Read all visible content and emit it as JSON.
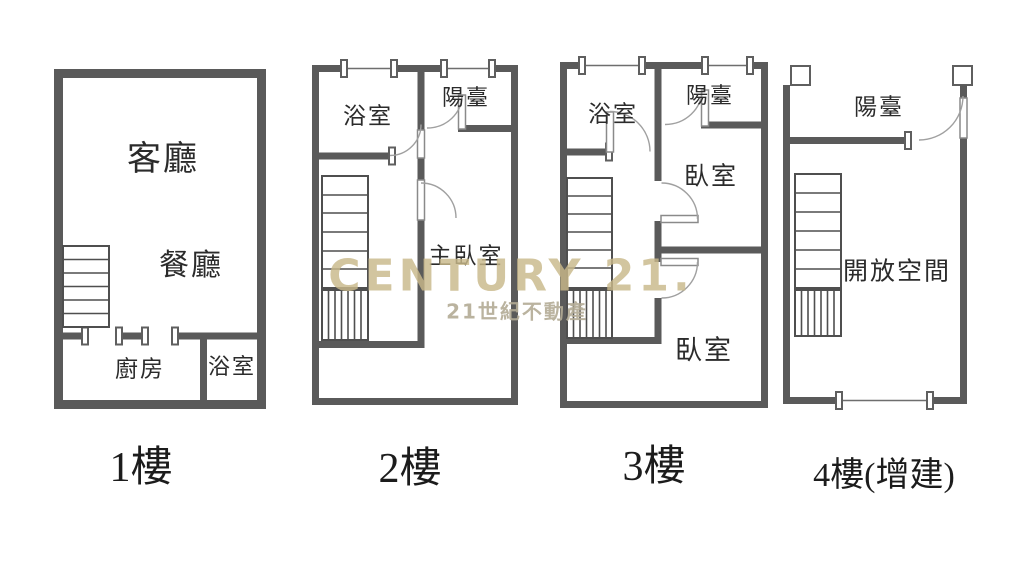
{
  "watermark": {
    "brand": "CENTURY 21.",
    "tagline": "21世紀不動產",
    "brand_color": "#c9b98a",
    "tagline_color": "#b3ab95"
  },
  "colors": {
    "background": "#ffffff",
    "wall": "#5a5a5a",
    "label_text": "#2b2b2b",
    "door_arc": "#a0a0a0"
  },
  "floors": [
    {
      "id": "floor-1",
      "label": "1樓",
      "rooms": {
        "living": "客廳",
        "dining": "餐廳",
        "kitchen": "廚房",
        "bath": "浴室"
      }
    },
    {
      "id": "floor-2",
      "label": "2樓",
      "rooms": {
        "bath": "浴室",
        "balcony": "陽臺",
        "master": "主臥室"
      }
    },
    {
      "id": "floor-3",
      "label": "3樓",
      "rooms": {
        "bath": "浴室",
        "balcony": "陽臺",
        "bedroom1": "臥室",
        "bedroom2": "臥室"
      }
    },
    {
      "id": "floor-4",
      "label": "4樓(增建)",
      "rooms": {
        "balcony": "陽臺",
        "open": "開放空間"
      }
    }
  ]
}
